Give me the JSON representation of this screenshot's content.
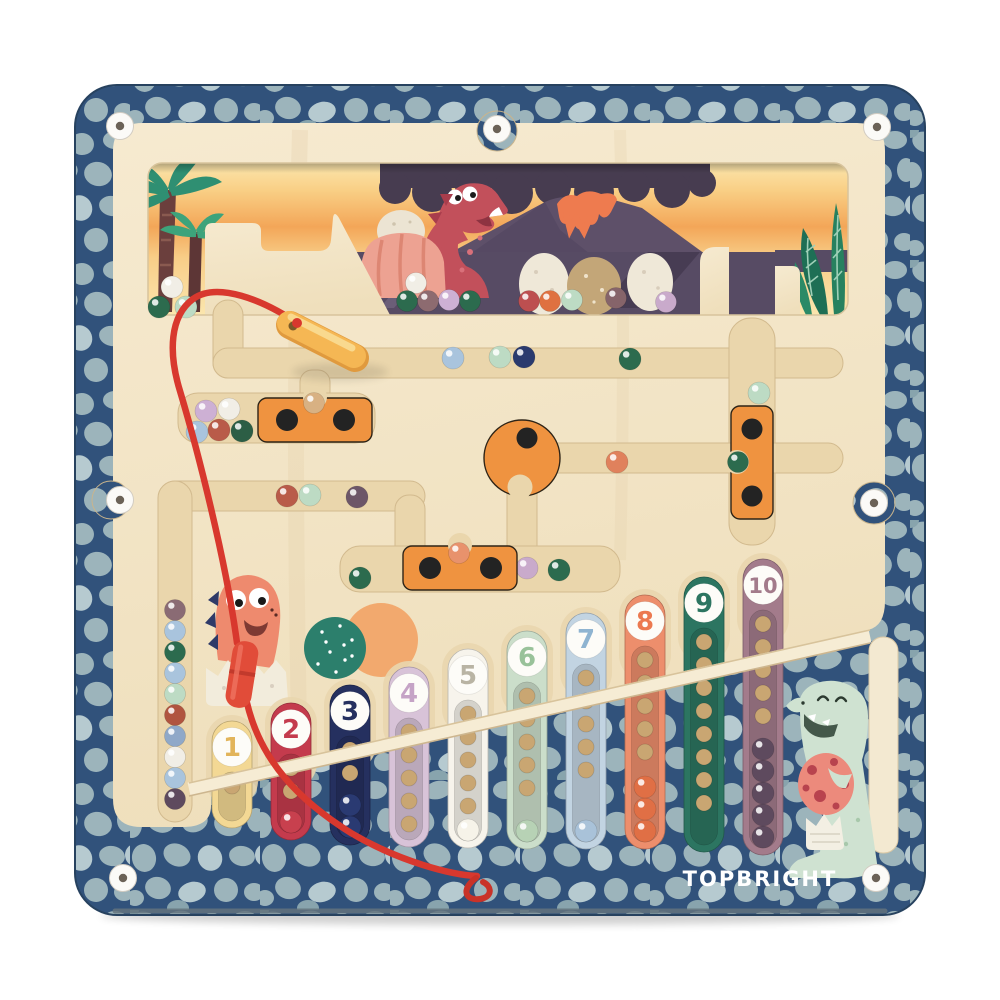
{
  "product": {
    "brand_logo": "TOPBRIGHT",
    "description": "Magnetic dinosaur counting maze board with numbered ball columns 1-10, magnetic wand on red cord"
  },
  "colors": {
    "frame_background": "#31527b",
    "pebble": "#9cb4bb",
    "pebble_light": "#b6cad0",
    "board_cream": "#f3e5c6",
    "groove": "#ead6ac",
    "slider_orange": "#ef9340",
    "pen_yellow": "#f5b754",
    "cord_red": "#d8382e",
    "screw_white": "#fbfaf7"
  },
  "columns": [
    {
      "label": "1",
      "tube_color": "#f3d894",
      "number_color": "#e2b45a",
      "hole_count": 1,
      "ball_count": 0,
      "ball_color": "#f3d894"
    },
    {
      "label": "2",
      "tube_color": "#c43b4d",
      "number_color": "#c43b4d",
      "hole_count": 2,
      "ball_count": 1,
      "ball_color": "#c8404e"
    },
    {
      "label": "3",
      "tube_color": "#25305f",
      "number_color": "#25305f",
      "hole_count": 2,
      "ball_count": 2,
      "ball_color": "#2a3a72"
    },
    {
      "label": "4",
      "tube_color": "#d8c3d8",
      "number_color": "#c5a3c6",
      "hole_count": 5,
      "ball_count": 0,
      "ball_color": "#cdb0d4"
    },
    {
      "label": "5",
      "tube_color": "#f7f4ec",
      "number_color": "#b9b4a4",
      "hole_count": 5,
      "ball_count": 1,
      "ball_color": "#f6f3e9"
    },
    {
      "label": "6",
      "tube_color": "#cbdeca",
      "number_color": "#99c29a",
      "hole_count": 5,
      "ball_count": 1,
      "ball_color": "#b7d2b5"
    },
    {
      "label": "7",
      "tube_color": "#c2d4e2",
      "number_color": "#8fb4d1",
      "hole_count": 5,
      "ball_count": 1,
      "ball_color": "#a9c2d9"
    },
    {
      "label": "8",
      "tube_color": "#ed8e6c",
      "number_color": "#ec7950",
      "hole_count": 5,
      "ball_count": 3,
      "ball_color": "#e06f45"
    },
    {
      "label": "9",
      "tube_color": "#2c7561",
      "number_color": "#2c7561",
      "hole_count": 8,
      "ball_count": 0,
      "ball_color": "#2c7561"
    },
    {
      "label": "10",
      "tube_color": "#a37b8b",
      "number_color": "#a37b8b",
      "hole_count": 5,
      "ball_count": 5,
      "ball_color": "#5e4a5e"
    }
  ],
  "collection_channel": {
    "balls": [
      "#8a6b74",
      "#a9c4dd",
      "#2c6b4e",
      "#a9c4dd",
      "#bddbc4",
      "#b0543f",
      "#8fa8c8",
      "#f1eee6",
      "#a9c4dd",
      "#5e4a5e"
    ]
  },
  "maze": {
    "free_balls": [
      {
        "x": 453,
        "y": 358,
        "color": "#a9c4dd"
      },
      {
        "x": 500,
        "y": 357,
        "color": "#bddbc4"
      },
      {
        "x": 524,
        "y": 357,
        "color": "#2a3a6e"
      },
      {
        "x": 630,
        "y": 359,
        "color": "#2c6b4e"
      },
      {
        "x": 759,
        "y": 393,
        "color": "#bddbc4"
      },
      {
        "x": 617,
        "y": 462,
        "color": "#e0815c"
      },
      {
        "x": 287,
        "y": 496,
        "color": "#b95b49"
      },
      {
        "x": 310,
        "y": 495,
        "color": "#bddbc4"
      },
      {
        "x": 357,
        "y": 497,
        "color": "#6d5668"
      },
      {
        "x": 360,
        "y": 578,
        "color": "#2c6b4e"
      },
      {
        "x": 527,
        "y": 568,
        "color": "#c9aacb"
      },
      {
        "x": 559,
        "y": 570,
        "color": "#2c6b4e"
      }
    ],
    "pocket_balls": [
      {
        "x": 206,
        "y": 411,
        "color": "#cdb0d4"
      },
      {
        "x": 229,
        "y": 409,
        "color": "#f1eee6"
      },
      {
        "x": 197,
        "y": 432,
        "color": "#a9c4dd"
      },
      {
        "x": 219,
        "y": 430,
        "color": "#b95b49"
      },
      {
        "x": 242,
        "y": 431,
        "color": "#2c5e45"
      }
    ],
    "notch_balls": [
      {
        "x": 314,
        "y": 403,
        "color": "#d8b183"
      },
      {
        "x": 459,
        "y": 553,
        "color": "#e8926c"
      },
      {
        "x": 738,
        "y": 462,
        "color": "#2c6b4e"
      }
    ],
    "sliders": [
      "horizontal-slider-top",
      "horizontal-slider-middle",
      "vertical-slider-right",
      "rotating-knob"
    ]
  },
  "scene": {
    "elements": [
      "palm-trees",
      "volcano",
      "smoke-cloud",
      "red-dinosaur",
      "dinosaur-eggs",
      "fern-leaves"
    ],
    "shelf_balls": [
      {
        "x": 416,
        "y": 283,
        "color": "#f1eee6"
      },
      {
        "x": 407,
        "y": 301,
        "color": "#2c6b4e"
      },
      {
        "x": 428,
        "y": 301,
        "color": "#8d6b70"
      },
      {
        "x": 449,
        "y": 300,
        "color": "#cdb0d4"
      },
      {
        "x": 470,
        "y": 301,
        "color": "#2c6b4e"
      },
      {
        "x": 529,
        "y": 301,
        "color": "#bd4f50"
      },
      {
        "x": 550,
        "y": 301,
        "color": "#df7140"
      },
      {
        "x": 572,
        "y": 300,
        "color": "#bddbc4"
      },
      {
        "x": 616,
        "y": 298,
        "color": "#86646a"
      },
      {
        "x": 666,
        "y": 302,
        "color": "#c9aacb"
      }
    ],
    "palm_pocket_balls": [
      {
        "x": 172,
        "y": 287,
        "color": "#f1eee6"
      },
      {
        "x": 159,
        "y": 307,
        "color": "#2c6b4e"
      },
      {
        "x": 186,
        "y": 307,
        "color": "#bddbc4"
      }
    ]
  },
  "decorations": [
    "baby-dinosaur-hatching",
    "teal-dotted-circle",
    "orange-circle",
    "green-dinosaur-with-egg"
  ]
}
